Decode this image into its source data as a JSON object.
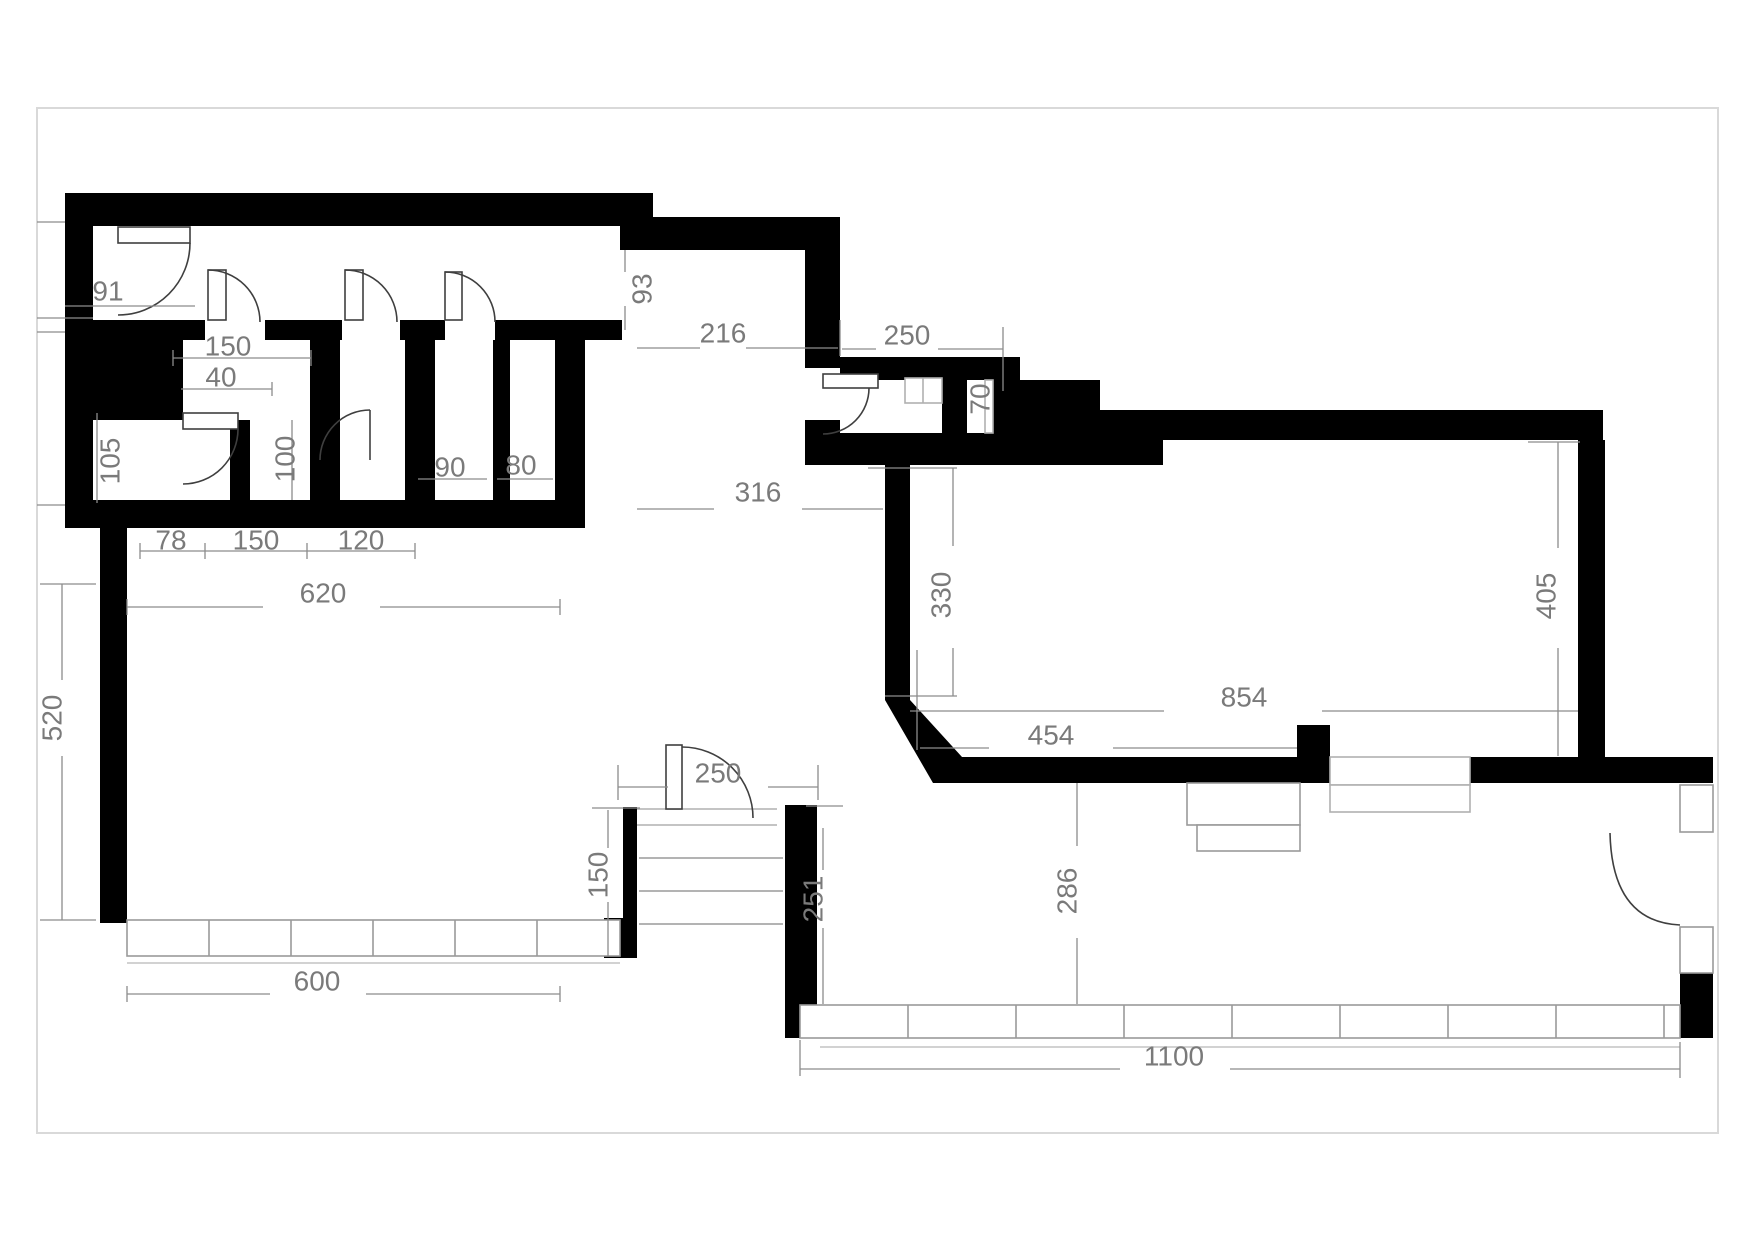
{
  "sheet": {
    "background": "#ffffff",
    "border_color": "#d9d9d9"
  },
  "plan": {
    "wall_color": "#000000",
    "dimension_color": "#7a7a7a",
    "dimension_line_color": "#8c8c8c",
    "door_color": "#3f3f3f",
    "window_color": "#b0b0b0"
  },
  "dimensions": {
    "hall_door_width": "91",
    "room1_door_width": "150",
    "room1_niche": "40",
    "left_room_width": "105",
    "room1_width": "100",
    "room3_width": "90",
    "room4_width": "80",
    "bottom_seg_78": "78",
    "bottom_seg_150": "150",
    "bottom_seg_120": "120",
    "upper_block_width": "620",
    "left_wall_length": "520",
    "bottom_left_window": "600",
    "corridor_niche": "93",
    "corridor_width": "216",
    "vestibule_width": "250",
    "vestibule_niche": "70",
    "passage_width": "316",
    "big_room_left": "330",
    "big_room_width": "854",
    "big_room_bottom": "454",
    "big_room_right": "405",
    "entrance_width": "250",
    "stairs_depth": "150",
    "lower_room_left": "251",
    "lower_room_height": "286",
    "bottom_window_width": "1100"
  }
}
